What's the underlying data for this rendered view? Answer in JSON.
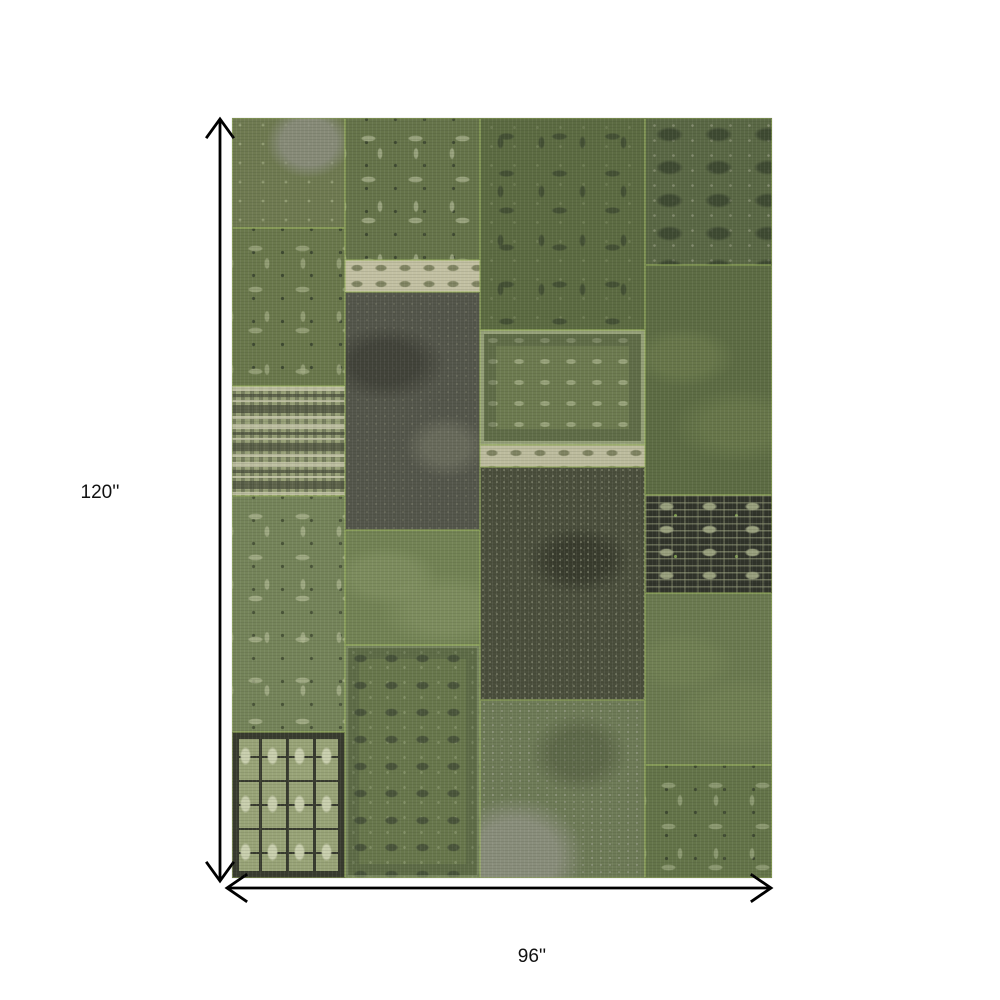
{
  "figure": {
    "kind": "rug-dimension-diagram",
    "background": "#ffffff"
  },
  "dimensions": {
    "height_label": "120''",
    "width_label": "96''",
    "arrow_color": "#000000",
    "label_color": "#111111"
  },
  "rug": {
    "description": "distressed green patchwork area rug",
    "base_color": "#6e7b50",
    "seam_color": "#9eb75f",
    "palette": {
      "olive": "#6e7b50",
      "sage_light": "#a8b38d",
      "cream": "#c3c1a3",
      "gray": "#8b8e7f",
      "charcoal": "#4a4e3c",
      "near_black": "#30332a"
    },
    "patches": [
      {
        "name": "top-left-worn",
        "pattern": "blotch",
        "x": 0,
        "y": 0,
        "w": 20.9,
        "h": 14.5,
        "base": "#6f7a51",
        "c1": "#8b8e7fd9",
        "c2": "#a3ad85a6"
      },
      {
        "name": "left-floral",
        "pattern": "floral",
        "x": 0,
        "y": 14.5,
        "w": 20.9,
        "h": 20.7,
        "base": "#6a784c",
        "c1": "#a3ad85b3",
        "c2": "#3f4a32"
      },
      {
        "name": "left-kilim-bands",
        "pattern": "bands",
        "x": 0,
        "y": 35.2,
        "w": 20.9,
        "h": 14.5,
        "base": "#97a077",
        "c1": "#c9c9adcc",
        "c2": "#474b3ab3"
      },
      {
        "name": "left-floral-light",
        "pattern": "floral",
        "x": 0,
        "y": 49.7,
        "w": 20.9,
        "h": 31.1,
        "base": "#75845a",
        "c1": "#b0b993b3",
        "c2": "#4a5539"
      },
      {
        "name": "left-turkmen-geometric",
        "pattern": "tribal-light",
        "x": 0,
        "y": 80.8,
        "w": 20.9,
        "h": 19.2,
        "base": "#99a478",
        "c1": "#c9cfae",
        "c2": "#383b2f"
      },
      {
        "name": "mid-floral-scroll",
        "pattern": "floral",
        "x": 20.9,
        "y": 0,
        "w": 25,
        "h": 18.7,
        "base": "#66744a",
        "c1": "#a8b28dbf",
        "c2": "#3f4a32"
      },
      {
        "name": "mid-cream-border",
        "pattern": "cream-band",
        "x": 20.9,
        "y": 18.7,
        "w": 25,
        "h": 4.2,
        "base": "#c3c1a3",
        "c1": "#6f7451",
        "c2": "#6f7451cc"
      },
      {
        "name": "mid-dark-gray",
        "pattern": "dark-worn",
        "x": 20.9,
        "y": 22.9,
        "w": 25,
        "h": 31.3,
        "base": "#54564b",
        "c1": "#75776699",
        "c2": "#3a3b33b3"
      },
      {
        "name": "mid-plain-green",
        "pattern": "plain",
        "x": 20.9,
        "y": 54.2,
        "w": 25,
        "h": 15.1,
        "base": "#738355",
        "c1": "#8c9b6b66",
        "c2": "#738355"
      },
      {
        "name": "mid-ornate-bordered",
        "pattern": "floral-dark",
        "x": 20.9,
        "y": 69.3,
        "w": 25,
        "h": 30.7,
        "base": "#68774c",
        "c1": "#9aa67e99",
        "c2": "#414b36cc"
      },
      {
        "name": "center-dark-tracery",
        "pattern": "tracery-dark",
        "x": 45.9,
        "y": 0,
        "w": 30.6,
        "h": 27.9,
        "base": "#5c6b42",
        "c1": "#3e4a31cc",
        "c2": "#8e9a7066"
      },
      {
        "name": "center-bordered-floral",
        "pattern": "border-frame",
        "x": 45.9,
        "y": 27.9,
        "w": 30.6,
        "h": 15.1,
        "base": "#6d7b50",
        "c1": "#a4ae87cc",
        "c2": "#49543a99"
      },
      {
        "name": "center-cream-strip",
        "pattern": "cream-band",
        "x": 45.9,
        "y": 43.0,
        "w": 30.6,
        "h": 2.9,
        "base": "#bdbc9e",
        "c1": "#6f7451",
        "c2": "#6f7451cc"
      },
      {
        "name": "center-dark-speckled",
        "pattern": "dark-speckle",
        "x": 45.9,
        "y": 45.9,
        "w": 30.6,
        "h": 30.7,
        "base": "#4a4e3c",
        "c1": "#888c74d9",
        "c2": "#6b6f59b3"
      },
      {
        "name": "center-mottled-gray",
        "pattern": "mottled-gray",
        "x": 45.9,
        "y": 76.6,
        "w": 30.6,
        "h": 23.4,
        "base": "#6e7b57",
        "c1": "#8e9181d9",
        "c2": "#a9ab9cb3"
      },
      {
        "name": "right-ornate-dark",
        "pattern": "ornate-dark",
        "x": 76.5,
        "y": 0,
        "w": 23.5,
        "h": 19.3,
        "base": "#5a6845",
        "c1": "#8f957ab3",
        "c2": "#3a452fd9"
      },
      {
        "name": "right-plain-dark",
        "pattern": "plain",
        "x": 76.5,
        "y": 19.3,
        "w": 23.5,
        "h": 30.3,
        "base": "#5d6c44",
        "c1": "#77865366",
        "c2": "#5d6c44"
      },
      {
        "name": "right-tribal-dark",
        "pattern": "tribal-dark",
        "x": 76.5,
        "y": 49.6,
        "w": 23.5,
        "h": 12.9,
        "base": "#30332a",
        "c1": "#99a07e",
        "c2": "#7fa04f"
      },
      {
        "name": "right-plain-green",
        "pattern": "plain",
        "x": 76.5,
        "y": 62.5,
        "w": 23.5,
        "h": 22.6,
        "base": "#6b7a50",
        "c1": "#85956033",
        "c2": "#6b7a50"
      },
      {
        "name": "right-floral-tracery",
        "pattern": "floral",
        "x": 76.5,
        "y": 85.1,
        "w": 23.5,
        "h": 14.9,
        "base": "#647449",
        "c1": "#9ba780b3",
        "c2": "#3f4a32"
      }
    ]
  }
}
